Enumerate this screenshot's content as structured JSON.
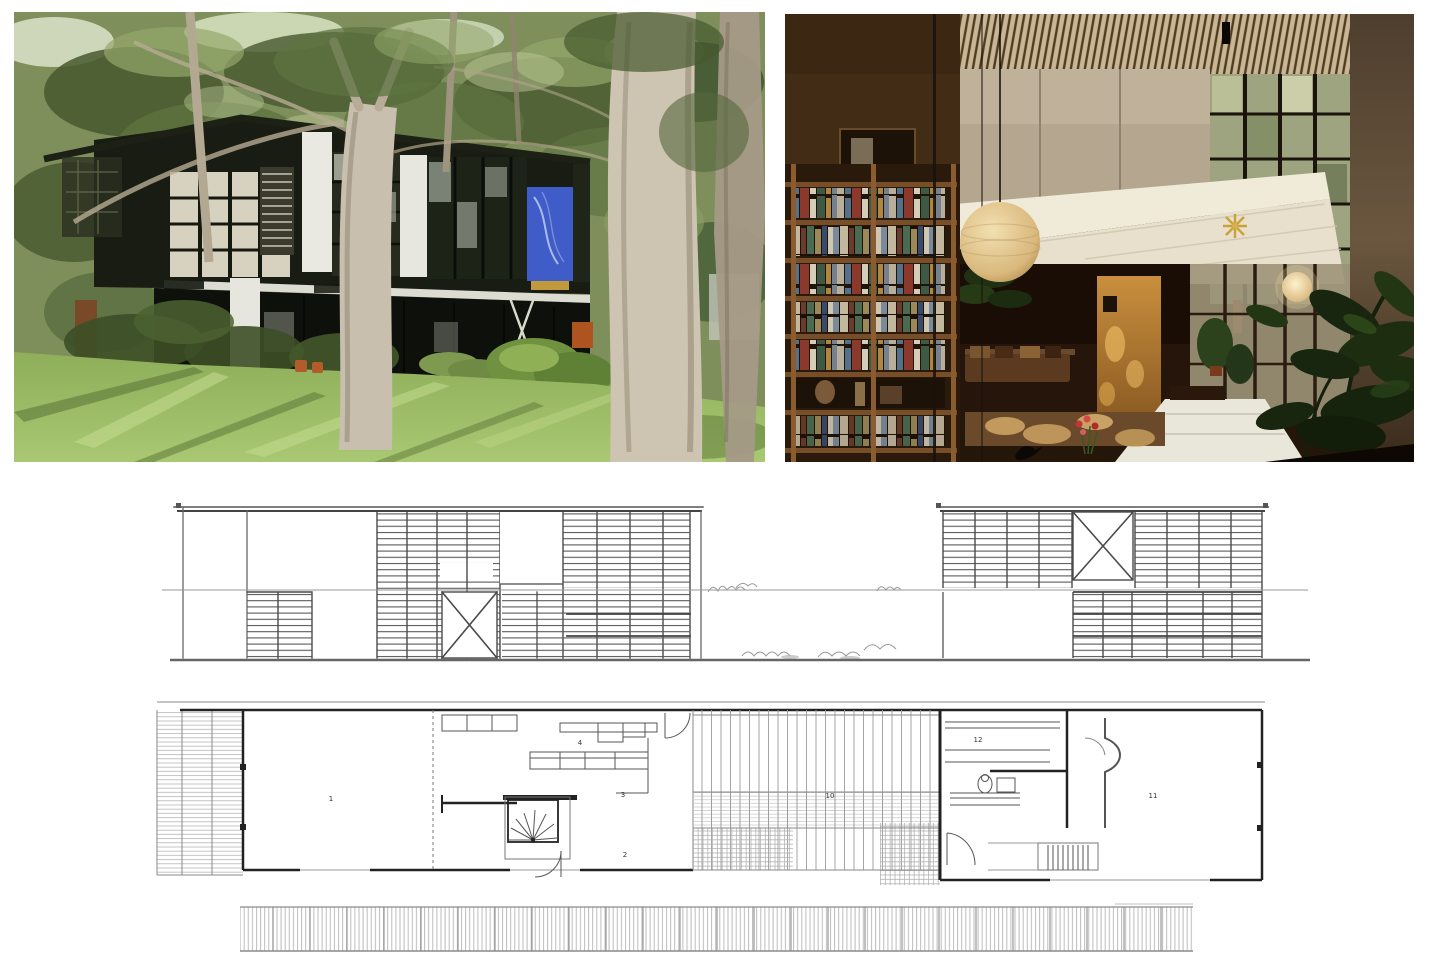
{
  "page": {
    "background_color": "#ffffff"
  },
  "collage": {
    "photo_exterior": {
      "alt": "Eames House exterior seen through eucalyptus trunks with lawn in foreground",
      "colors": {
        "banner_blue": "#3f5cc8",
        "banner_gold": "#c29a3e",
        "panel_orange": "#ad5420",
        "steel_dark": "#15180f",
        "grass": "#9bba68",
        "trunk_pale": "#cdc4b2"
      }
    },
    "photo_interior": {
      "alt": "Double-height living room with bookshelf wall, paper lantern, mezzanine and tall windows",
      "colors": {
        "ceiling_tan": "#c9b694",
        "wood_panel": "#c98f3e",
        "lantern": "#e9d2a0",
        "plant_green": "#1d2e10",
        "white_shaft": "#efe8d7"
      }
    },
    "elevation_drawing": {
      "alt": "Long elevation of house and studio blocks with louvered panels and X-braced bays",
      "ink": "#4a4a4a"
    },
    "floor_plan": {
      "alt": "Ground-floor plan: house, central courtyard and studio",
      "ink": "#444444",
      "room_labels": [
        {
          "number": "1"
        },
        {
          "number": "2"
        },
        {
          "number": "3"
        },
        {
          "number": "4"
        },
        {
          "number": "10"
        },
        {
          "number": "11"
        },
        {
          "number": "12"
        }
      ]
    },
    "site_strip": {
      "alt": "Finely hatched site retaining-wall strip",
      "ink": "#9a9a9a"
    }
  }
}
